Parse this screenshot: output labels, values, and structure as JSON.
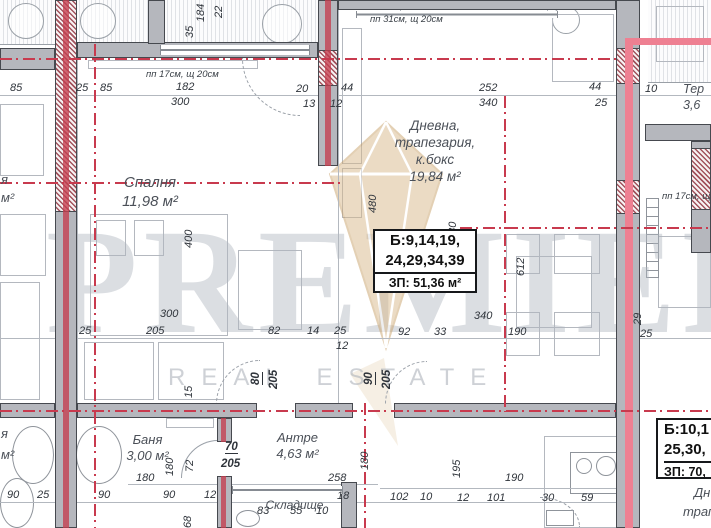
{
  "watermark": {
    "brand": "PREMIER",
    "tagline": "REAL ESTATE",
    "logo_color": "#d8b88a"
  },
  "colors": {
    "axis_red": "#c83a4e",
    "wall_gray": "#b5b7bd",
    "accent_pink": "#ee8092",
    "hatch_red": "#a2525c"
  },
  "rooms": {
    "bedroom": {
      "name": "Спалня",
      "area": "11,98 м²"
    },
    "living": {
      "name": "Дневна,",
      "name2": "трапезария,",
      "name3": "к.бокс",
      "area": "19,84 м²"
    },
    "bath": {
      "name": "Баня",
      "area": "3,00 м²"
    },
    "hall": {
      "name": "Антре",
      "area": "4,63 м²"
    },
    "storage": {
      "name": "Складище"
    },
    "terrace": {
      "name": "Тер",
      "area": "3,6"
    }
  },
  "apartment_box": {
    "line1": "Б:9,14,19,",
    "line2": "24,29,34,39",
    "line3": "ЗП: 51,36 м²"
  },
  "neighbor_box": {
    "line1": "Б:10,1",
    "line2": "25,30,",
    "line3": "ЗП: 70,"
  },
  "dimensions": [
    {
      "t": "85",
      "x": 10,
      "y": 82
    },
    {
      "t": "25",
      "x": 76,
      "y": 82
    },
    {
      "t": "85",
      "x": 100,
      "y": 82
    },
    {
      "t": "пп 17см, щ 20см",
      "x": 146,
      "y": 69,
      "c": "note"
    },
    {
      "t": "182",
      "x": 176,
      "y": 81
    },
    {
      "t": "300",
      "x": 171,
      "y": 96
    },
    {
      "t": "20",
      "x": 296,
      "y": 83
    },
    {
      "t": "13",
      "x": 303,
      "y": 98
    },
    {
      "t": "12",
      "x": 330,
      "y": 98
    },
    {
      "t": "44",
      "x": 341,
      "y": 82
    },
    {
      "t": "пп 31см, щ 20см",
      "x": 370,
      "y": 14,
      "c": "note"
    },
    {
      "t": "252",
      "x": 479,
      "y": 82
    },
    {
      "t": "340",
      "x": 479,
      "y": 97
    },
    {
      "t": "44",
      "x": 589,
      "y": 81
    },
    {
      "t": "25",
      "x": 595,
      "y": 97
    },
    {
      "t": "10",
      "x": 645,
      "y": 83
    },
    {
      "t": "35",
      "x": 196,
      "y": 38,
      "r": 1
    },
    {
      "t": "184",
      "x": 207,
      "y": 22,
      "r": 1
    },
    {
      "t": "22",
      "x": 225,
      "y": 18,
      "r": 1
    },
    {
      "t": "480",
      "x": 379,
      "y": 213,
      "r": 1
    },
    {
      "t": "480",
      "x": 459,
      "y": 240,
      "r": 1
    },
    {
      "t": "400",
      "x": 195,
      "y": 248,
      "r": 1
    },
    {
      "t": "612",
      "x": 527,
      "y": 276,
      "r": 1
    },
    {
      "t": "пп 17см, щ",
      "x": 662,
      "y": 191,
      "c": "note"
    },
    {
      "t": "300",
      "x": 160,
      "y": 308
    },
    {
      "t": "340",
      "x": 474,
      "y": 310
    },
    {
      "t": "25",
      "x": 79,
      "y": 325
    },
    {
      "t": "205",
      "x": 146,
      "y": 325
    },
    {
      "t": "82",
      "x": 268,
      "y": 325
    },
    {
      "t": "14",
      "x": 307,
      "y": 325
    },
    {
      "t": "25",
      "x": 334,
      "y": 325
    },
    {
      "t": "12",
      "x": 336,
      "y": 340
    },
    {
      "t": "92",
      "x": 398,
      "y": 326
    },
    {
      "t": "33",
      "x": 434,
      "y": 326
    },
    {
      "t": "190",
      "x": 508,
      "y": 326
    },
    {
      "t": "29",
      "x": 644,
      "y": 325,
      "r": 1
    },
    {
      "t": "25",
      "x": 640,
      "y": 328
    },
    {
      "t": "80",
      "x": 263,
      "y": 384,
      "r": 1,
      "c": "door"
    },
    {
      "t": "205",
      "x": 280,
      "y": 389,
      "r": 1,
      "c": "door2"
    },
    {
      "t": "90",
      "x": 376,
      "y": 384,
      "r": 1,
      "c": "door"
    },
    {
      "t": "205",
      "x": 393,
      "y": 389,
      "r": 1,
      "c": "door2"
    },
    {
      "t": "15",
      "x": 195,
      "y": 398,
      "r": 1
    },
    {
      "t": "70",
      "x": 225,
      "y": 441,
      "c": "door"
    },
    {
      "t": "205",
      "x": 221,
      "y": 458,
      "c": "door2"
    },
    {
      "t": "180",
      "x": 176,
      "y": 476,
      "r": 1
    },
    {
      "t": "72",
      "x": 196,
      "y": 472,
      "r": 1
    },
    {
      "t": "180",
      "x": 136,
      "y": 472
    },
    {
      "t": "90",
      "x": 7,
      "y": 489
    },
    {
      "t": "25",
      "x": 37,
      "y": 489
    },
    {
      "t": "90",
      "x": 98,
      "y": 489
    },
    {
      "t": "90",
      "x": 163,
      "y": 489
    },
    {
      "t": "12",
      "x": 204,
      "y": 489
    },
    {
      "t": "68",
      "x": 194,
      "y": 528,
      "r": 1
    },
    {
      "t": "258",
      "x": 328,
      "y": 472
    },
    {
      "t": "18",
      "x": 337,
      "y": 490
    },
    {
      "t": "83",
      "x": 257,
      "y": 505
    },
    {
      "t": "55",
      "x": 290,
      "y": 505
    },
    {
      "t": "10",
      "x": 316,
      "y": 505
    },
    {
      "t": "180",
      "x": 371,
      "y": 470,
      "r": 1
    },
    {
      "t": "195",
      "x": 463,
      "y": 478,
      "r": 1
    },
    {
      "t": "190",
      "x": 505,
      "y": 472
    },
    {
      "t": "102",
      "x": 390,
      "y": 491
    },
    {
      "t": "10",
      "x": 420,
      "y": 491
    },
    {
      "t": "12",
      "x": 457,
      "y": 492
    },
    {
      "t": "101",
      "x": 487,
      "y": 492
    },
    {
      "t": "30",
      "x": 542,
      "y": 492
    },
    {
      "t": "59",
      "x": 581,
      "y": 492
    },
    {
      "t": "я",
      "x": 1,
      "y": 174,
      "c": "room"
    },
    {
      "t": "м²",
      "x": 1,
      "y": 192,
      "c": "room"
    },
    {
      "t": "я",
      "x": 1,
      "y": 428,
      "c": "room"
    },
    {
      "t": "м²",
      "x": 1,
      "y": 449,
      "c": "room"
    },
    {
      "t": "Дн",
      "x": 694,
      "y": 487,
      "c": "room"
    },
    {
      "t": "трап",
      "x": 683,
      "y": 506,
      "c": "room"
    }
  ]
}
